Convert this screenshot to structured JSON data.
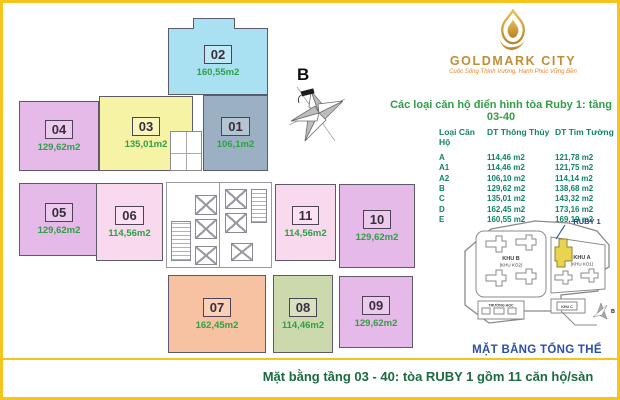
{
  "header": {
    "brand": "GOLDMARK CITY",
    "tagline": "Cuộc Sống Thịnh Vượng, Hạnh Phúc Vững Bền",
    "section_title": "Các loại căn hộ điển hình tòa Ruby 1: tầng 03-40"
  },
  "floorplan": {
    "compass_label": "B",
    "units": [
      {
        "no": "01",
        "area": "106,1m2",
        "fill": "#9bb1c3"
      },
      {
        "no": "02",
        "area": "160,55m2",
        "fill": "#aae1f2"
      },
      {
        "no": "03",
        "area": "135,01m2",
        "fill": "#f7f3a4"
      },
      {
        "no": "04",
        "area": "129,62m2",
        "fill": "#e5b9e8"
      },
      {
        "no": "05",
        "area": "129,62m2",
        "fill": "#e5b9e8"
      },
      {
        "no": "06",
        "area": "114,56m2",
        "fill": "#f8d9ee"
      },
      {
        "no": "07",
        "area": "162,45m2",
        "fill": "#f6c2a1"
      },
      {
        "no": "08",
        "area": "114,46m2",
        "fill": "#cbd9ad"
      },
      {
        "no": "09",
        "area": "129,62m2",
        "fill": "#e5b9e8"
      },
      {
        "no": "10",
        "area": "129,62m2",
        "fill": "#e5b9e8"
      },
      {
        "no": "11",
        "area": "114,56m2",
        "fill": "#f8d9ee"
      }
    ]
  },
  "area_table": {
    "headers": [
      "Loại Căn Hộ",
      "DT Thông Thủy",
      "DT Tim Tường"
    ],
    "rows": [
      {
        "code": "A",
        "thong_thuy": "114,46 m2",
        "tim_tuong": "121,78 m2"
      },
      {
        "code": "A1",
        "thong_thuy": "114,46 m2",
        "tim_tuong": "121,75 m2"
      },
      {
        "code": "A2",
        "thong_thuy": "106,10 m2",
        "tim_tuong": "114,14 m2"
      },
      {
        "code": "B",
        "thong_thuy": "129,62 m2",
        "tim_tuong": "138,68 m2"
      },
      {
        "code": "C",
        "thong_thuy": "135,01 m2",
        "tim_tuong": "143,32 m2"
      },
      {
        "code": "D",
        "thong_thuy": "162,45 m2",
        "tim_tuong": "173,16 m2"
      },
      {
        "code": "E",
        "thong_thuy": "160,55 m2",
        "tim_tuong": "169,19 m2"
      }
    ]
  },
  "sitemap": {
    "ruby_label": "RUBY 1",
    "khu_b": "KHU B",
    "khu_b_sub": "(KHU KO2)",
    "khu_a": "KHU A",
    "khu_a_sub": "(KHU KO1)",
    "school": "TRƯỜNG HỌC",
    "khu_c": "KHU C",
    "compass_label": "B",
    "title": "MẶT BẰNG TỔNG THỂ"
  },
  "footer": {
    "caption": "Mặt bằng tầng 03 - 40:  tòa RUBY 1 gồm 11 căn hộ/sàn"
  },
  "colors": {
    "frame": "#f6c51d",
    "area_text": "#2fa045",
    "table_text": "#0f8468",
    "brand_gold": "#bf8f35",
    "map_blue": "#2b4fa8",
    "footer_green": "#1c6b40",
    "ruby_highlight": "#e9d44f"
  }
}
